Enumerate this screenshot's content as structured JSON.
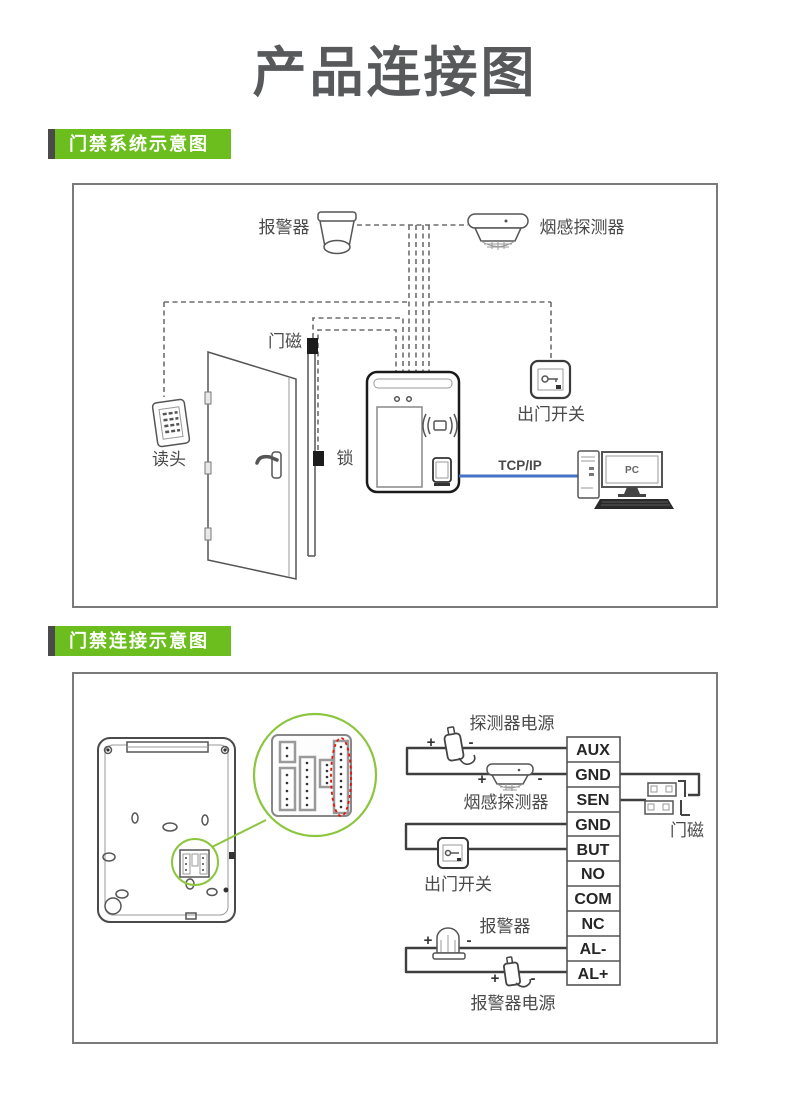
{
  "title": "产品连接图",
  "sections": {
    "s1": "门禁系统示意图",
    "s2": "门禁连接示意图"
  },
  "diagram1": {
    "labels": {
      "alarm": "报警器",
      "smoke": "烟感探测器",
      "door_magnet": "门磁",
      "reader": "读头",
      "lock": "锁",
      "exit_switch": "出门开关",
      "tcpip": "TCP/IP",
      "pc": "PC"
    }
  },
  "diagram2": {
    "labels": {
      "detector_power": "探测器电源",
      "smoke": "烟感探测器",
      "door_magnet": "门磁",
      "exit_switch": "出门开关",
      "alarm": "报警器",
      "alarm_power": "报警器电源"
    },
    "signs": {
      "plus": "+",
      "minus": "-"
    },
    "terminals": [
      "AUX",
      "GND",
      "SEN",
      "GND",
      "BUT",
      "NO",
      "COM",
      "NC",
      "AL-",
      "AL+"
    ]
  },
  "colors": {
    "accent_green": "#6cbe1e",
    "bar_gray": "#4a4a4b",
    "wire_blue": "#4472c4",
    "highlight_red": "#e8100c"
  }
}
